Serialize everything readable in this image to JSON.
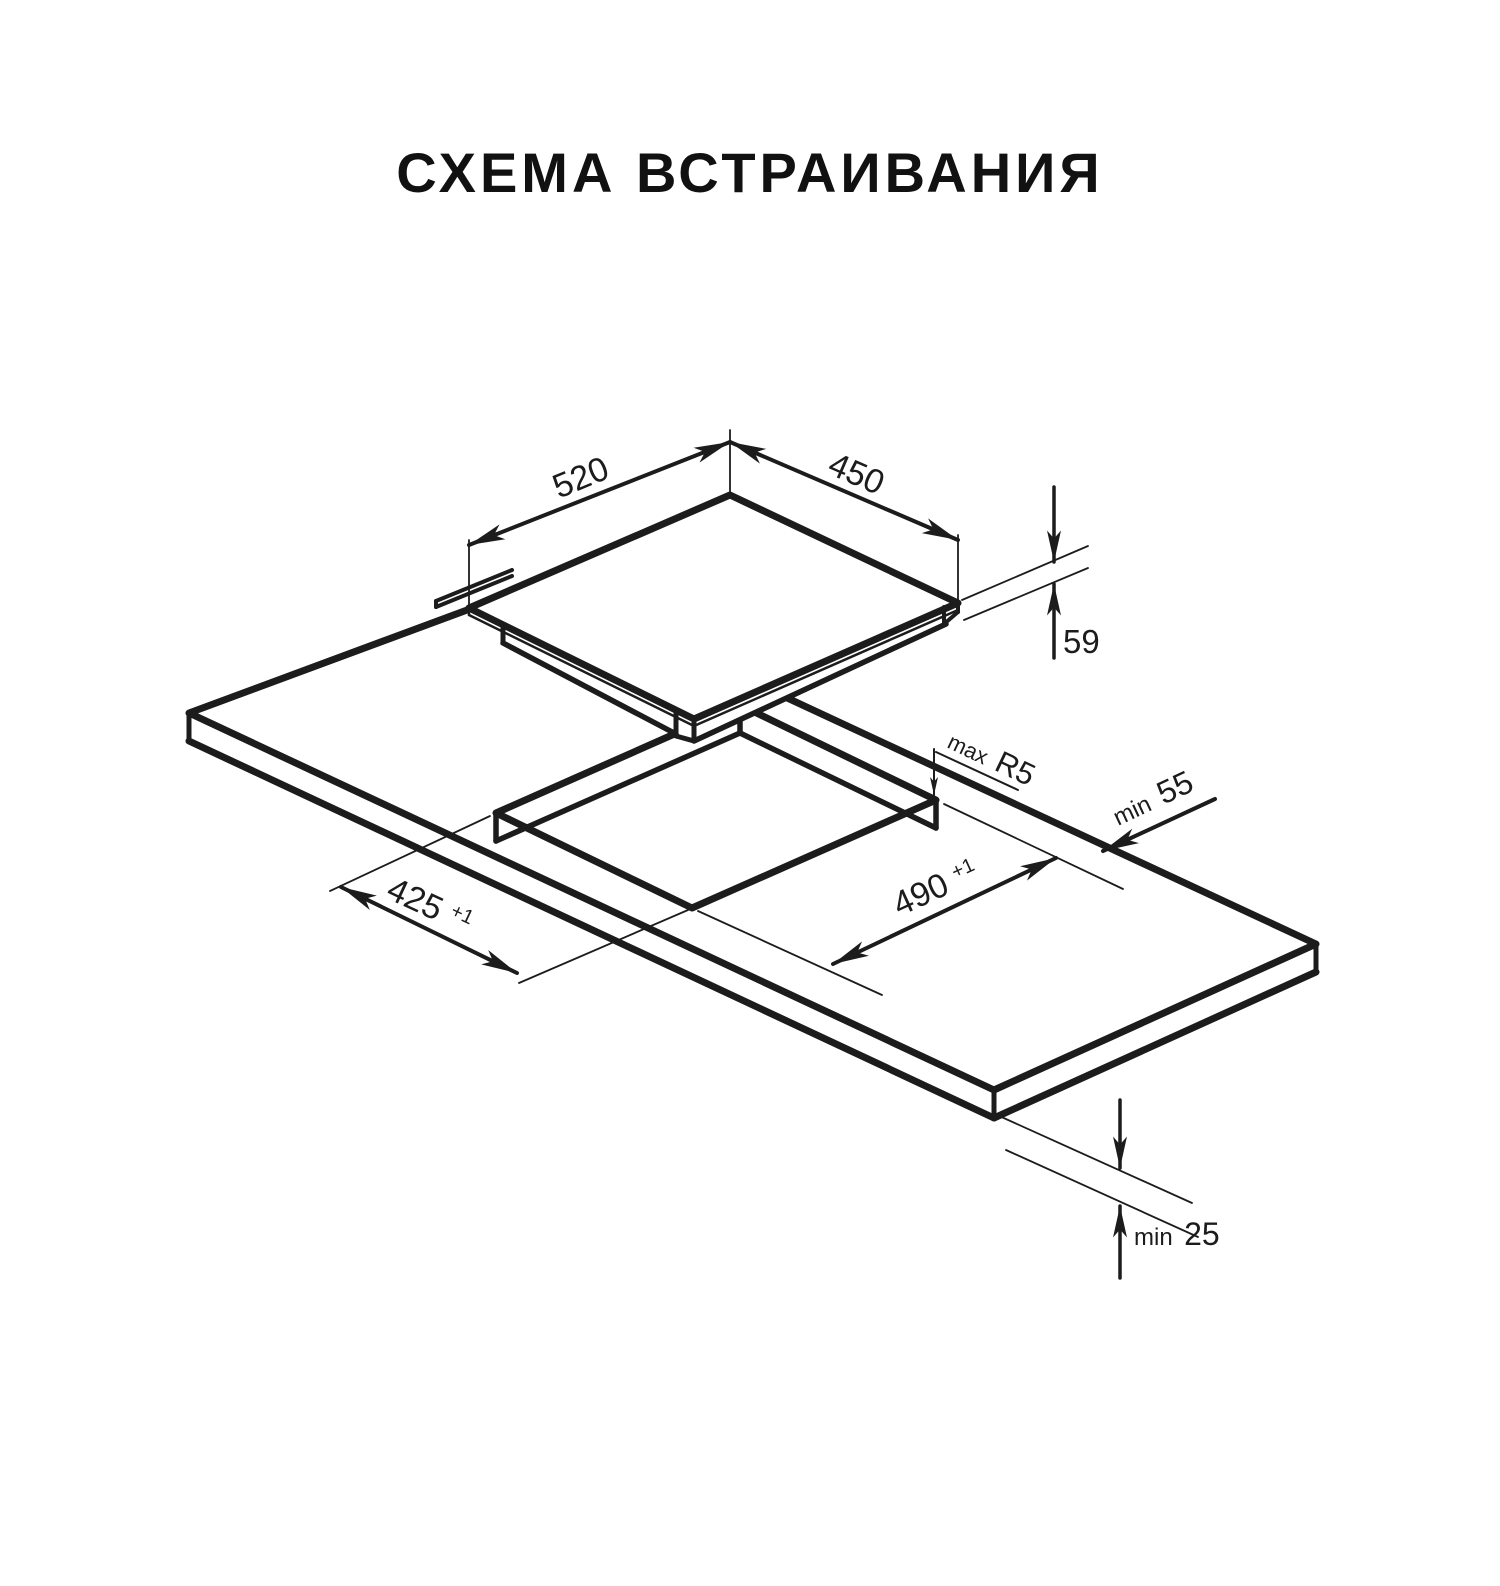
{
  "title": "СХЕМА ВСТРАИВАНИЯ",
  "drawing": {
    "kind": "isometric installation drawing of a built-in hob and worktop cutout",
    "line_color": "#1c1c1c",
    "dimensions": {
      "panel_width": {
        "value": "520"
      },
      "panel_depth": {
        "value": "450"
      },
      "panel_height": {
        "value": "59"
      },
      "cutout_depth": {
        "value": "425",
        "tol": "+1"
      },
      "cutout_width": {
        "value": "490",
        "tol": "+1"
      },
      "corner_radius": {
        "prefix": "max",
        "value": "R5"
      },
      "rear_clearance": {
        "prefix": "min",
        "value": "55"
      },
      "bottom_clearance": {
        "prefix": "min",
        "value": "25"
      }
    }
  }
}
